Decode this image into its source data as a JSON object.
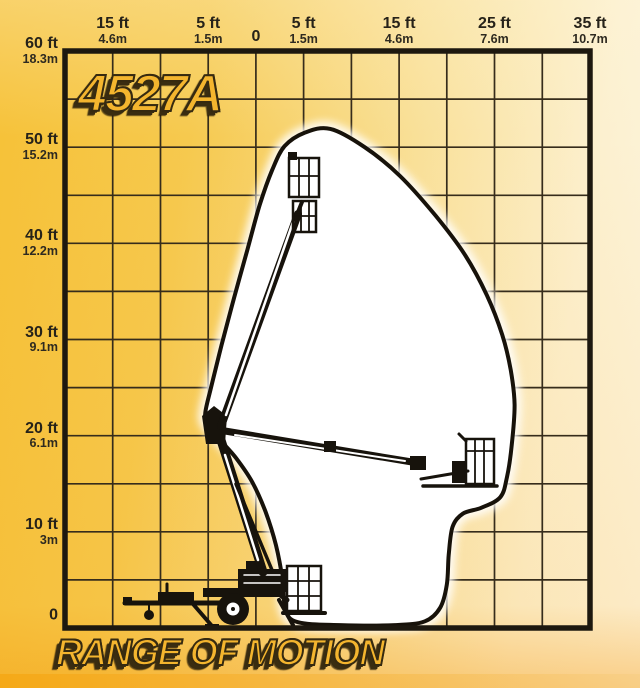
{
  "page": {
    "model_logo": "4527A",
    "caption": "RANGE OF MOTION"
  },
  "colors": {
    "background_gold": "#f6c136",
    "background_cream": "#fdf6e2",
    "grid_line": "#362c1b",
    "chart_border": "#1d180f",
    "envelope_fill": "#ffffff",
    "envelope_outline": "#17120a",
    "machine_ink": "#17130c",
    "heading_gold": "#f4b52e",
    "heading_outline": "#362a10",
    "label_text": "#262219"
  },
  "chart_data": {
    "type": "area",
    "title": "4527A",
    "caption": "RANGE OF MOTION",
    "description_visible": "Working envelope (range of motion) of trailer-mounted articulating boom lift, shown with stowed, max-height and max-reach boom positions",
    "grid": true,
    "x_axis": {
      "unit_primary": "ft",
      "unit_secondary": "m",
      "range_ft": [
        -20,
        35
      ],
      "gridline_step_ft": 5,
      "ticks": [
        {
          "ft": -15,
          "ft_label": "15 ft",
          "m_label": "4.6m"
        },
        {
          "ft": -5,
          "ft_label": "5 ft",
          "m_label": "1.5m"
        },
        {
          "ft": 0,
          "ft_label": "0",
          "m_label": ""
        },
        {
          "ft": 5,
          "ft_label": "5 ft",
          "m_label": "1.5m"
        },
        {
          "ft": 15,
          "ft_label": "15 ft",
          "m_label": "4.6m"
        },
        {
          "ft": 25,
          "ft_label": "25 ft",
          "m_label": "7.6m"
        },
        {
          "ft": 35,
          "ft_label": "35 ft",
          "m_label": "10.7m"
        }
      ]
    },
    "y_axis": {
      "unit_primary": "ft",
      "unit_secondary": "m",
      "range_ft": [
        0,
        60
      ],
      "gridline_step_ft": 5,
      "ticks": [
        {
          "ft": 60,
          "ft_label": "60 ft",
          "m_label": "18.3m"
        },
        {
          "ft": 50,
          "ft_label": "50 ft",
          "m_label": "15.2m"
        },
        {
          "ft": 40,
          "ft_label": "40 ft",
          "m_label": "12.2m"
        },
        {
          "ft": 30,
          "ft_label": "30 ft",
          "m_label": "9.1m"
        },
        {
          "ft": 20,
          "ft_label": "20 ft",
          "m_label": "6.1m"
        },
        {
          "ft": 10,
          "ft_label": "10 ft",
          "m_label": "3m"
        },
        {
          "ft": 0,
          "ft_label": "0",
          "m_label": ""
        }
      ]
    },
    "envelope_ft": [
      [
        5.1,
        51.5
      ],
      [
        7.8,
        51.9
      ],
      [
        11.4,
        50.0
      ],
      [
        15.1,
        47.0
      ],
      [
        18.8,
        42.9
      ],
      [
        21.9,
        38.8
      ],
      [
        24.2,
        34.6
      ],
      [
        25.8,
        30.5
      ],
      [
        26.7,
        26.8
      ],
      [
        27.1,
        23.2
      ],
      [
        26.8,
        19.0
      ],
      [
        26.3,
        15.7
      ],
      [
        25.6,
        13.6
      ],
      [
        23.6,
        12.5
      ],
      [
        21.7,
        11.9
      ],
      [
        20.6,
        10.5
      ],
      [
        20.2,
        7.6
      ],
      [
        20.0,
        4.5
      ],
      [
        19.3,
        2.1
      ],
      [
        17.7,
        0.7
      ],
      [
        14.6,
        0.3
      ],
      [
        8.8,
        0.3
      ],
      [
        4.4,
        0.6
      ],
      [
        3.1,
        1.9
      ],
      [
        2.8,
        5.0
      ],
      [
        2.1,
        8.6
      ],
      [
        1.0,
        12.1
      ],
      [
        -0.4,
        15.2
      ],
      [
        -2.1,
        17.7
      ],
      [
        -3.7,
        19.5
      ],
      [
        -5.1,
        21.2
      ],
      [
        -5.3,
        22.4
      ],
      [
        -4.7,
        25.0
      ],
      [
        -3.6,
        29.4
      ],
      [
        -2.3,
        34.3
      ],
      [
        -0.9,
        39.3
      ],
      [
        0.4,
        44.0
      ],
      [
        1.7,
        47.6
      ],
      [
        3.0,
        50.1
      ]
    ]
  }
}
